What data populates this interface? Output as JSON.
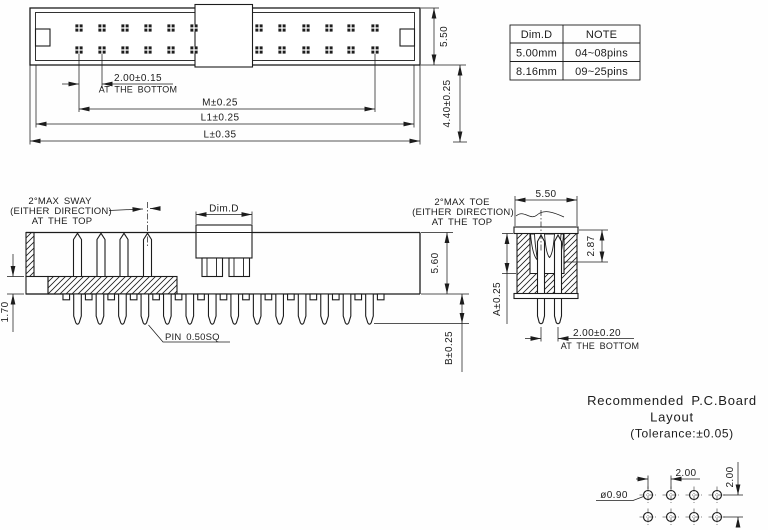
{
  "top_view": {
    "pitch": "2.00±0.15",
    "pitch_note": "AT THE BOTTOM",
    "dim_m": "M±0.25",
    "dim_l1": "L1±0.25",
    "dim_l": "L±0.35",
    "body_width": "5.50",
    "dim_440": "4.40±0.25"
  },
  "spec_table": {
    "col1_header": "Dim.D",
    "col2_header": "NOTE",
    "rows": [
      {
        "dim_d": "5.00mm",
        "note": "04~08pins"
      },
      {
        "dim_d": "8.16mm",
        "note": "09~25pins"
      }
    ]
  },
  "side_view": {
    "sway_line1": "2°MAX SWAY",
    "sway_line2": "(EITHER DIRECTION)",
    "sway_line3": "AT THE TOP",
    "dim_d_label": "Dim.D",
    "body_height": "5.60",
    "base_thickness": "1.70",
    "pin_tail": "B±0.25",
    "pin_note": "PIN  0.50SQ"
  },
  "end_view": {
    "toe_line1": "2°MAX TOE",
    "toe_line2": "(EITHER DIRECTION)",
    "toe_line3": "AT THE TOP",
    "body_width": "5.50",
    "dim_287": "2.87",
    "dim_a": "A±0.25",
    "pitch": "2.00±0.20",
    "pitch_note": "AT THE BOTTOM"
  },
  "pcb_layout": {
    "title_line1": "Recommended  P.C.Board",
    "title_line2": "Layout",
    "title_line3": "(Tolerance:±0.05)",
    "pitch_x": "2.00",
    "pitch_y": "2.00",
    "hole_dia": "ø0.90"
  },
  "colors": {
    "line": "#1c1c1c",
    "background": "#fefefe"
  },
  "geometry": {
    "top_view_pin_columns_left": [
      79,
      102,
      125,
      148,
      171,
      194
    ],
    "top_view_pin_columns_right": [
      259,
      282,
      306,
      329,
      351,
      375
    ],
    "top_view_pin_rows": [
      28,
      50
    ],
    "side_top_pin_xs": [
      77.5,
      101,
      124,
      147.5
    ],
    "side_bottom_pin_count": 14,
    "side_bottom_pin_start_x": 77.5,
    "side_bottom_pin_pitch": 22.46,
    "pcb_hole_cols": [
      648,
      671,
      694,
      717
    ],
    "pcb_hole_rows": [
      495,
      517
    ],
    "pcb_hole_radius": 4.5
  }
}
